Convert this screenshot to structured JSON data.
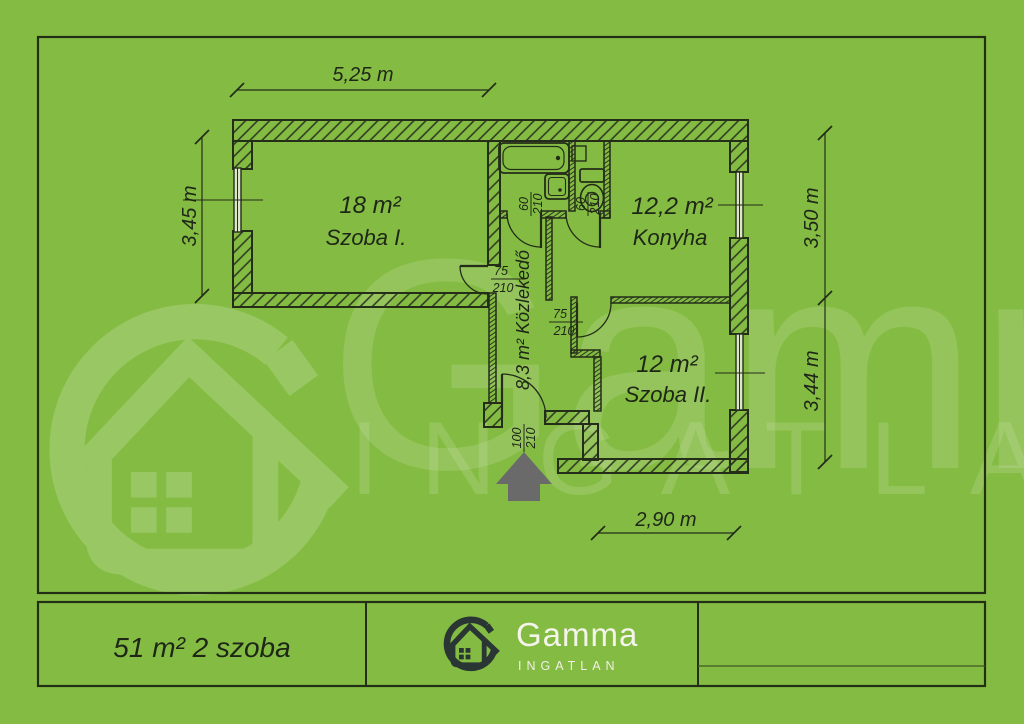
{
  "watermark": {
    "brand": "Gamma",
    "sub": "INGATLAN"
  },
  "footer": {
    "summary": "51 m² 2 szoba",
    "brand": "Gamma",
    "brand_sub": "INGATLAN"
  },
  "rooms": {
    "szoba1": {
      "area": "18 m²",
      "name": "Szoba I."
    },
    "konyha": {
      "area": "12,2 m²",
      "name": "Konyha"
    },
    "szoba2": {
      "area": "12 m²",
      "name": "Szoba II."
    },
    "kozlekedo": {
      "label": "8,3 m² Közlekedő"
    }
  },
  "dimensions": {
    "top": "5,25 m",
    "left": "3,45 m",
    "right_upper": "3,50 m",
    "right_lower": "3,44 m",
    "bottom": "2,90 m"
  },
  "doors": {
    "szoba1": {
      "width": "75",
      "height": "210"
    },
    "bathroom": {
      "width": "60",
      "height": "210"
    },
    "wc": {
      "width": "60",
      "height": "210"
    },
    "szoba2": {
      "width": "75",
      "height": "210"
    },
    "entrance": {
      "width": "100",
      "height": "210"
    }
  },
  "colors": {
    "background": "#84BC43",
    "line": "#232D18",
    "logo_dark": "#2A3634",
    "arrow_gray": "#6A6A6A",
    "watermark": "#FFFFFF"
  }
}
